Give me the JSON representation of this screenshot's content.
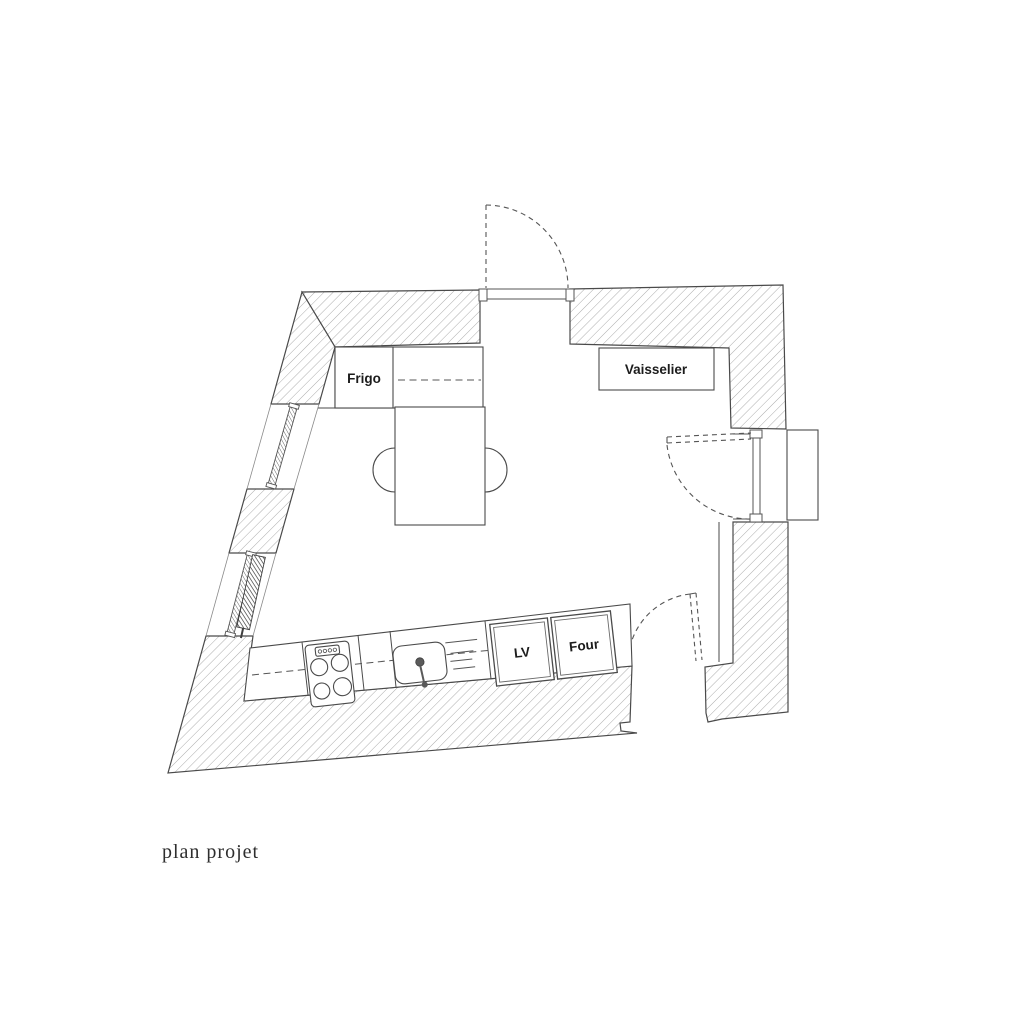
{
  "caption": "plan projet",
  "plan": {
    "type": "kitchen-floor-plan",
    "labels": {
      "fridge": "Frigo",
      "dresser": "Vaisselier",
      "dishwasher": "LV",
      "oven": "Four"
    },
    "features": [
      "top-entry-door-with-swing-arc",
      "right-window-door-with-swing-arc",
      "bottom-right-door-with-swing-arc",
      "two-windows-in-left-wall",
      "radiator-along-left-wall",
      "stove-with-four-burners",
      "sink-with-faucet",
      "drainer-grooves",
      "dining-table-with-two-seats",
      "lower-worktop-counter",
      "upper-counter-next-to-fridge"
    ],
    "colors": {
      "line": "#4a4a4a",
      "hatch": "#a3a3a3",
      "background": "#ffffff",
      "caption_text": "#2e2e2e",
      "label_text": "#1c1c1c"
    }
  }
}
